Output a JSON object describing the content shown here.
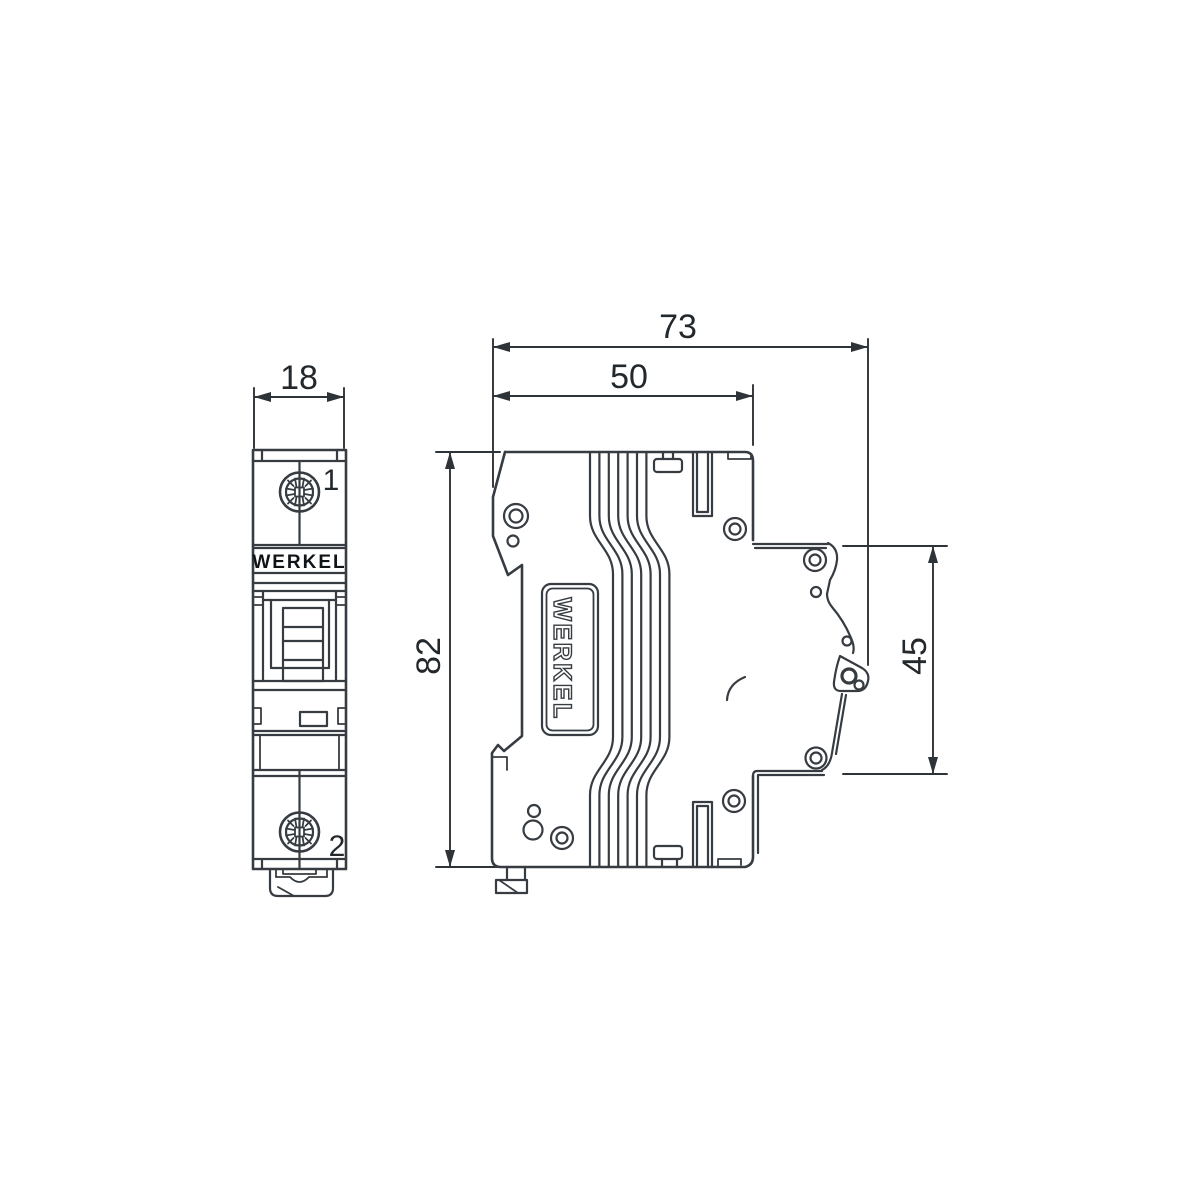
{
  "drawing": {
    "background_color": "#ffffff",
    "line_color": "#363c41",
    "text_color": "#23282c",
    "front_view": {
      "width_dim": "18",
      "terminal_top_label": "1",
      "terminal_bottom_label": "2",
      "brand_label": "WERKEL"
    },
    "side_view": {
      "overall_depth_dim": "73",
      "body_depth_dim": "50",
      "height_dim": "82",
      "din_section_dim": "45",
      "brand_label": "WERKEL"
    }
  }
}
